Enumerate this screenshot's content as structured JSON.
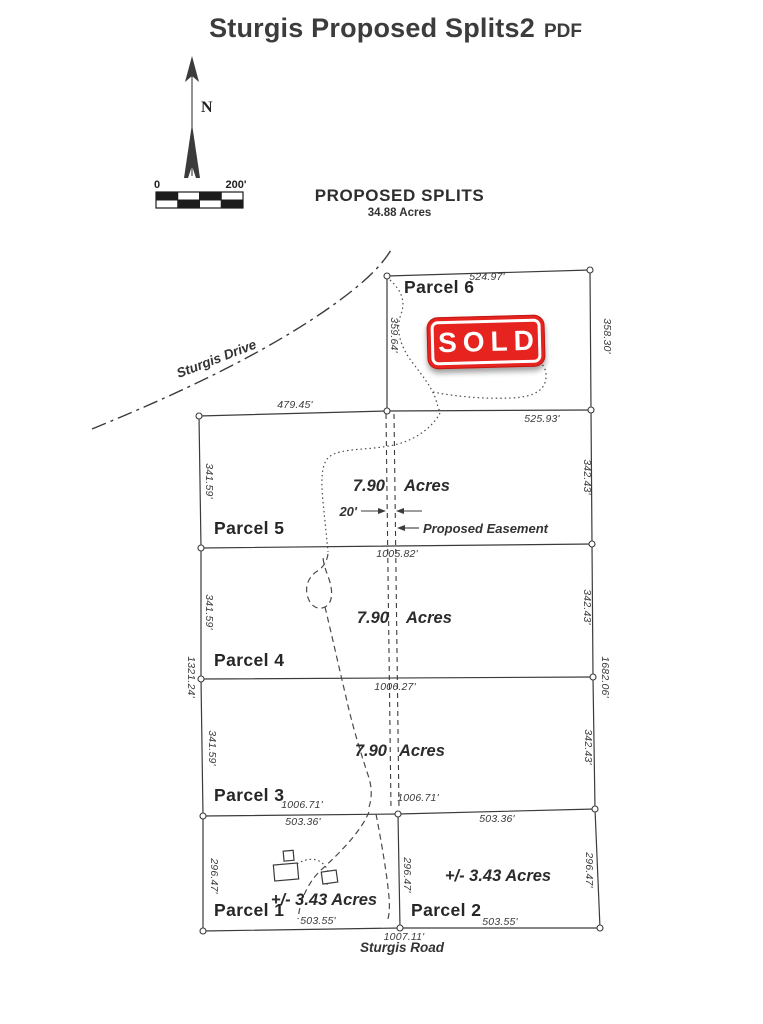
{
  "page": {
    "title": "Sturgis Proposed Splits2",
    "format_badge": "PDF"
  },
  "map": {
    "heading": "PROPOSED SPLITS",
    "total_acres": "34.88 Acres",
    "compass_label": "N",
    "scale_bar": {
      "start_label": "0",
      "end_label": "200'"
    },
    "sold_stamp": "SOLD",
    "roads": {
      "drive": "Sturgis Drive",
      "road": "Sturgis Road"
    },
    "easement": {
      "width_label": "20'",
      "name": "Proposed Easement"
    },
    "overall": {
      "west": "1321.24'",
      "east": "1682.06'",
      "south": "1007.11'"
    },
    "parcels": [
      {
        "name": "Parcel 1",
        "acres": "+/- 3.43 Acres",
        "north": "503.36'",
        "south": "503.55'",
        "west": "296.47'"
      },
      {
        "name": "Parcel 2",
        "acres": "+/- 3.43 Acres",
        "north": "503.36'",
        "south": "503.55'",
        "west": "296.47'",
        "east": "296.47'"
      },
      {
        "name": "Parcel 3",
        "acres_value": "7.90",
        "acres_unit": "Acres",
        "west": "341.59'",
        "east": "342.43'",
        "south_left": "1006.71'",
        "south_right": "1006.71'"
      },
      {
        "name": "Parcel 4",
        "acres_value": "7.90",
        "acres_unit": "Acres",
        "west": "341.59'",
        "east": "342.43'",
        "south": "1006.27'"
      },
      {
        "name": "Parcel 5",
        "acres_value": "7.90",
        "acres_unit": "Acres",
        "west": "341.59'",
        "east": "342.43'",
        "north": "479.45'",
        "south": "1005.82'"
      },
      {
        "name": "Parcel 6",
        "north": "524.97'",
        "south": "525.93'",
        "west": "359.64'",
        "east": "358.30'"
      }
    ],
    "colors": {
      "sold_red": "#e6231f",
      "line_ink": "#3b3b3b"
    }
  }
}
